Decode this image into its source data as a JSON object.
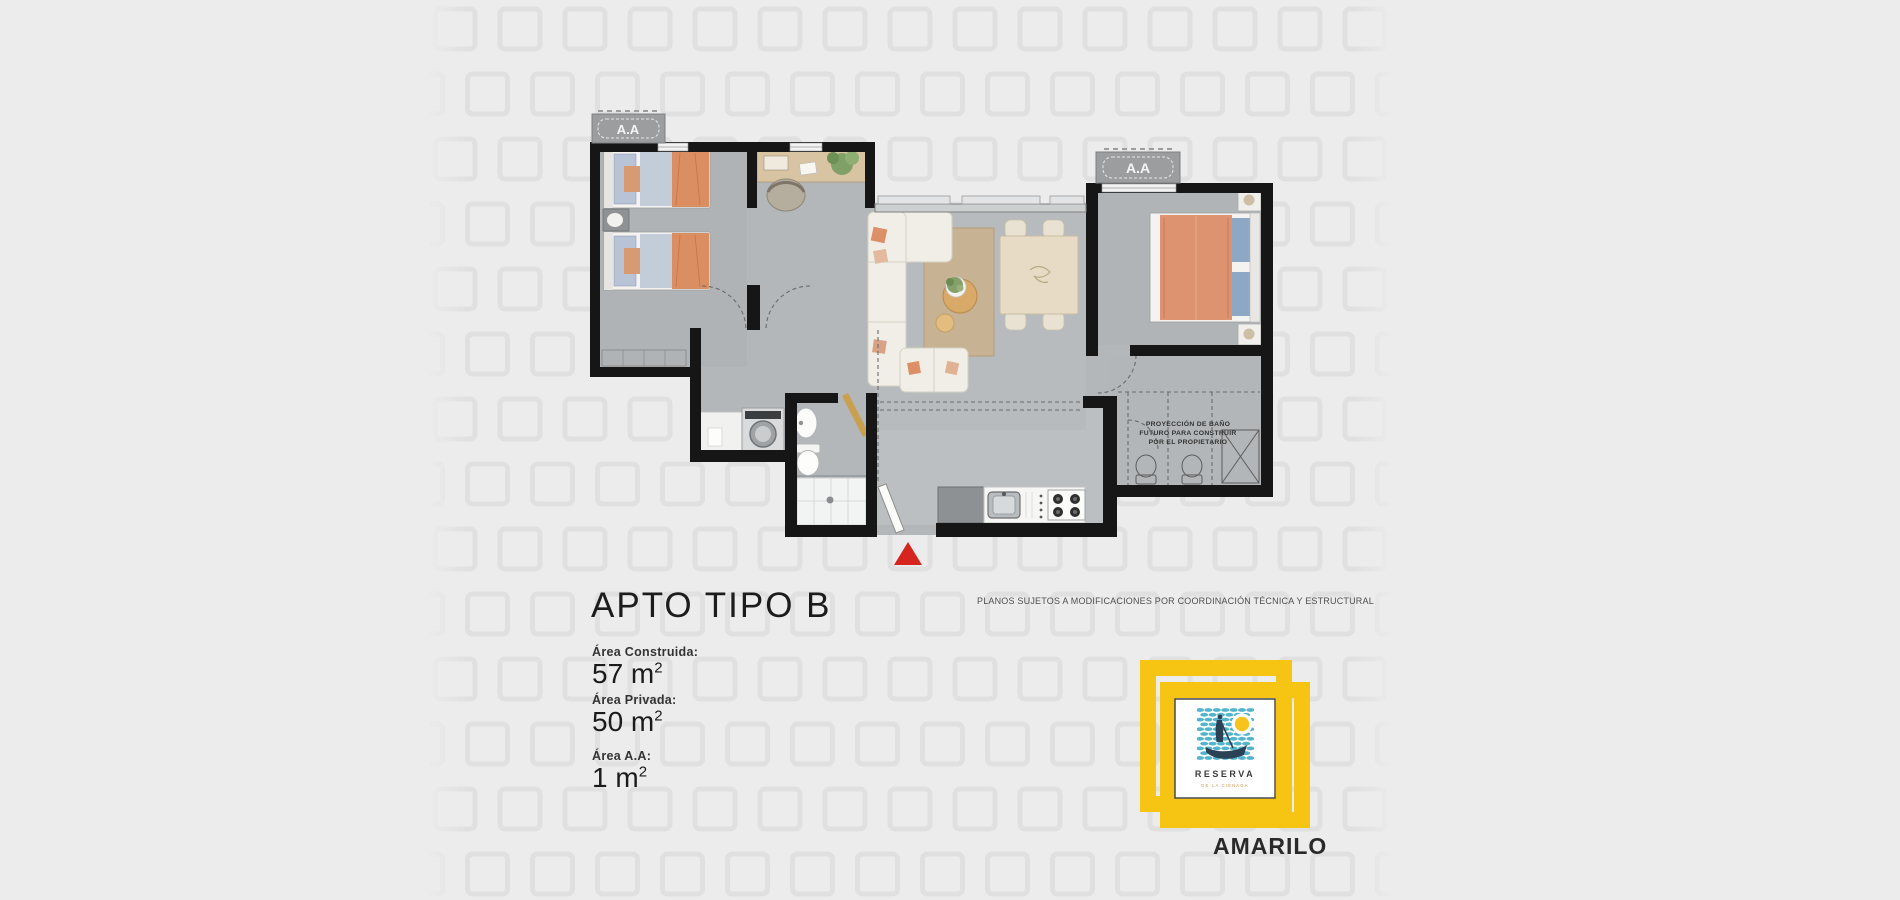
{
  "background": {
    "color": "#ececec",
    "pattern_square_color": "#e0e0e0",
    "pattern_band_x": 428,
    "pattern_band_width": 965
  },
  "plan": {
    "wall_color": "#161616",
    "floor_color": "#b4b7ba",
    "accent_orange": "#dd8f68",
    "rug_color": "#c8b294",
    "wood_color": "#d8c3a3",
    "entrance_marker_color": "#d6251f",
    "ac_label_left": "A.A",
    "ac_label_right": "A.A",
    "projection_note_l1": "PROYECCIÓN DE BAÑO",
    "projection_note_l2": "FUTURO PARA CONSTRUIR",
    "projection_note_l3": "POR EL PROPIETARIO"
  },
  "info": {
    "title": "APTO TIPO B",
    "areas": [
      {
        "label": "Área Construida:",
        "value": "57",
        "unit": " m",
        "sup": "2"
      },
      {
        "label": "Área Privada:",
        "value": "50",
        "unit": " m",
        "sup": "2"
      },
      {
        "label": "Área A.A:",
        "value": "1",
        "unit": " m",
        "sup": "2"
      }
    ]
  },
  "disclaimer": "PLANOS SUJETOS A MODIFICACIONES POR COORDINACIÓN TÉCNICA Y ESTRUCTURAL",
  "logo": {
    "frame_color": "#f6c513",
    "wave_color": "#53b5cb",
    "sun_color": "#f6c41c",
    "silhouette_color": "#2b4156",
    "name": "RESERVA",
    "subtitle": "DE LA CIÉNAGA",
    "brand": "AMARILO"
  }
}
